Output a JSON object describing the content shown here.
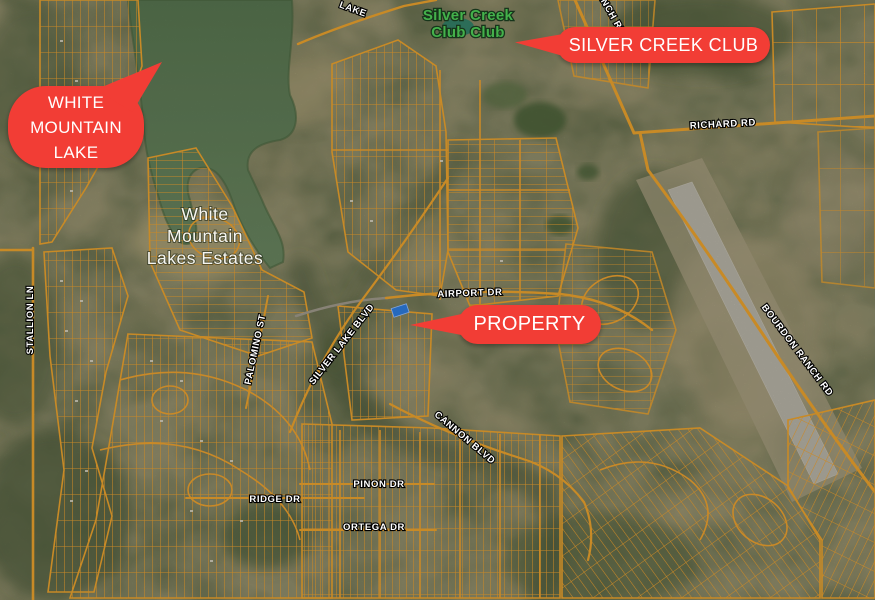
{
  "map": {
    "kind": "annotated-satellite-parcel-map",
    "colors": {
      "callout_red": "#f23d35",
      "parcel_orange": "#eea22f",
      "lake_green": "#5d7c55",
      "golf_label_green": "#44b14b",
      "property_blue": "#2e7ce0",
      "terrain_base": "#8b8a69"
    },
    "callouts": {
      "white_mountain_lake": "WHITE MOUNTAIN LAKE",
      "silver_creek_club": "SILVER CREEK CLUB",
      "property": "PROPERTY"
    },
    "place_labels": {
      "golf_line1": "Silver Creek",
      "golf_line2": "Club Club",
      "community_line1": "White",
      "community_line2": "Mountain",
      "community_line3": "Lakes Estates"
    },
    "road_labels": {
      "lake_partial": "LAKE",
      "ranch_partial": "RANCH RD",
      "richard": "RICHARD RD",
      "stallion": "STALLION LN",
      "airport": "AIRPORT DR",
      "palomino": "PALOMINO ST",
      "silver_lake": "SILVER LAKE BLVD",
      "cannon": "CANNON BLVD",
      "pinon": "PINON DR",
      "ridge": "RIDGE DR",
      "ortega": "ORTEGA DR",
      "bourdon": "BOURDON RANCH RD"
    }
  }
}
